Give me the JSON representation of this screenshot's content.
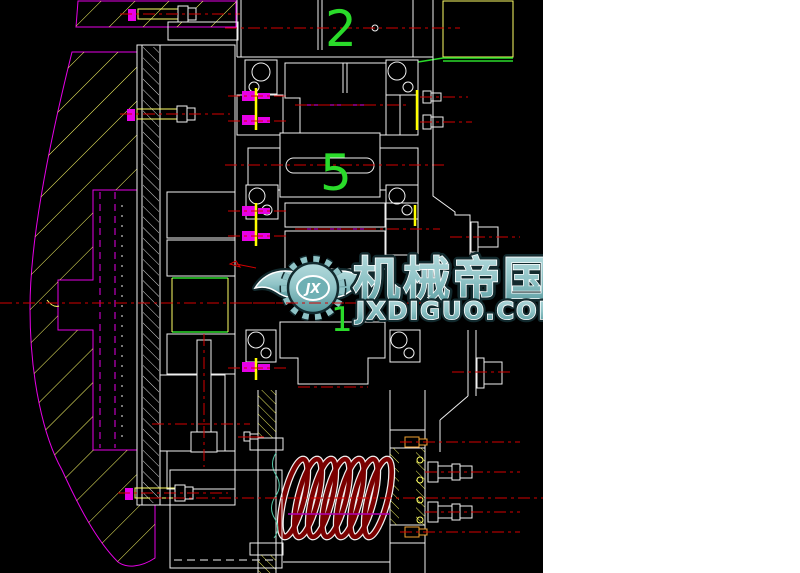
{
  "drawing": {
    "description": "black-background CAD section view of a gear/clutch transmission assembly with coil spring",
    "part_labels": [
      {
        "number": "2"
      },
      {
        "number": "5"
      },
      {
        "number": "1"
      }
    ]
  },
  "watermark": {
    "logo_text": "JX",
    "title": "机械帝国",
    "url": "JXDIGUO.COM"
  },
  "colors": {
    "page_bg": "#ffffff",
    "canvas_bg": "#000000",
    "line_white": "#f0f0f0",
    "line_magenta": "#e600e6",
    "line_yellow": "#ffff66",
    "line_bright_yellow": "#ffff00",
    "centerline_red": "#d40000",
    "spring_dark_red": "#7a0000",
    "label_green": "#2adb2a",
    "break_line_teal": "#56c8a8",
    "bolt_orange": "#f0a030",
    "detail_purple": "#b400b4",
    "watermark_teal": "#8fc3c6",
    "watermark_teal_dark": "#5f9ea2",
    "watermark_outline_dark": "#122a2e"
  }
}
